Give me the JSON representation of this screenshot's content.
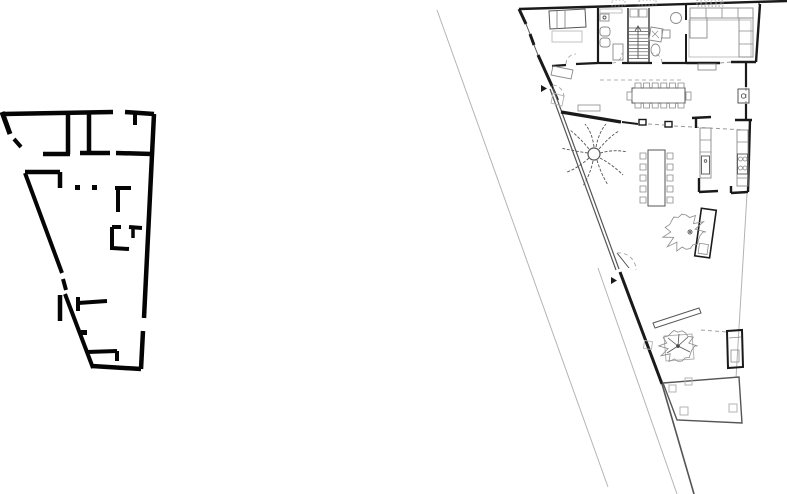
{
  "canvas": {
    "width": 787,
    "height": 494,
    "background": "#ffffff"
  },
  "colors": {
    "schematic_ink": "#050505",
    "wall": "#1a1a1a",
    "mid_line": "#555555",
    "furniture": "#8a8a8a",
    "light_gray": "#b3b3b3",
    "dashed": "#999999",
    "hairline": "#b5b5b5"
  },
  "left_plan": {
    "label": "schematic key plan — thick black walls, triangular footprint",
    "style": "solid black poché walls with door gaps"
  },
  "right_plan": {
    "label": "detailed ground floor plan — triangular house on sloping street",
    "features": [
      "street boundary lines",
      "bedroom with bed",
      "bathroom with sink, wc, bidet",
      "staircase with up arrow",
      "second wc with shower",
      "living room with L-shaped sofa",
      "long dining table with twelve chairs",
      "entry door with swing arc",
      "triangular courtyard with palm tree",
      "second dining table with ten chairs",
      "galley kitchen with sink and stove",
      "planter box with shrub",
      "garden bench",
      "tree in square planter",
      "storage closet",
      "lower terrace room with columns"
    ]
  }
}
